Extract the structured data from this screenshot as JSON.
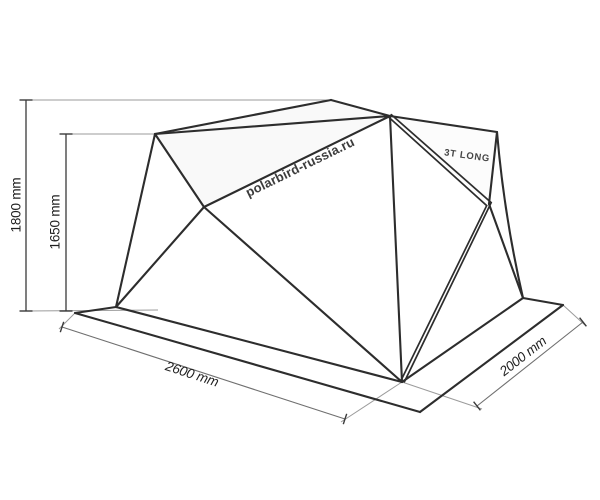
{
  "diagram": {
    "type": "tent-dimension-drawing",
    "watermark": "polarbird-russia.ru",
    "model_label": "3T LONG",
    "dimensions": {
      "height_outer": "1800 mm",
      "height_inner": "1650 mm",
      "width_front": "2600 mm",
      "depth_side": "2000 mm"
    },
    "colors": {
      "background": "#ffffff",
      "line": "#2d2d2d",
      "dim_line": "#6f6f6f",
      "dim_vertical": "#3a3a3a",
      "extension_line": "#9b9b9b",
      "text": "#1f1f1f"
    }
  }
}
